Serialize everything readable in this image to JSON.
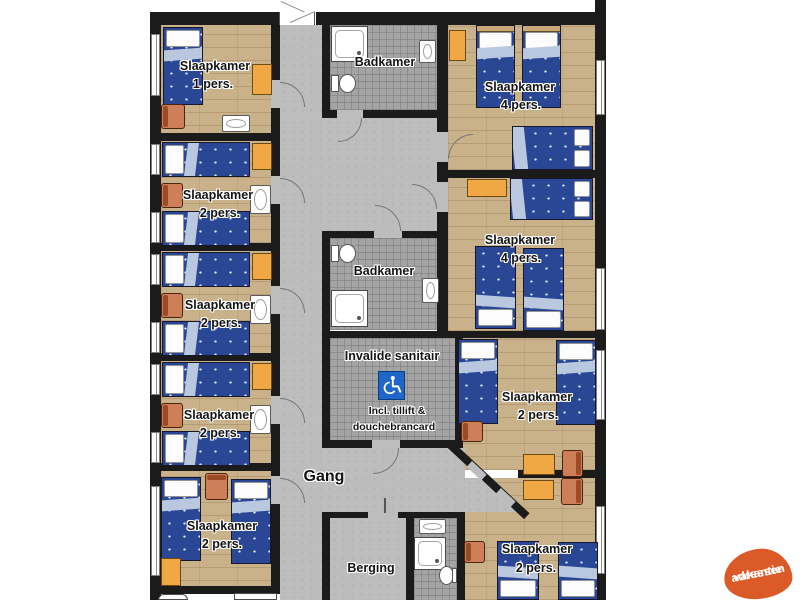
{
  "plan": {
    "rooms": {
      "left1": {
        "line1": "Slaapkamer",
        "line2": "1 pers."
      },
      "left2": {
        "line1": "Slaapkamer",
        "line2": "2 pers."
      },
      "left3": {
        "line1": "Slaapkamer",
        "line2": "2 pers."
      },
      "left4": {
        "line1": "Slaapkamer",
        "line2": "2 pers."
      },
      "left5": {
        "line1": "Slaapkamer",
        "line2": "2 pers."
      },
      "right1": {
        "line1": "Slaapkamer",
        "line2": "4 pers."
      },
      "right2": {
        "line1": "Slaapkamer",
        "line2": "4 pers."
      },
      "right3": {
        "line1": "Slaapkamer",
        "line2": "2 pers."
      },
      "right4": {
        "line1": "Slaapkamer",
        "line2": "2 pers."
      },
      "bath_top": {
        "label": "Badkamer"
      },
      "bath_mid": {
        "label": "Badkamer"
      },
      "invalide": {
        "label": "Invalide sanitair",
        "note1": "Incl. tillift &",
        "note2": "douchebrancard"
      },
      "hallway": {
        "label": "Gang"
      },
      "storage": {
        "label": "Berging"
      }
    },
    "icons": [
      "wheelchair-icon",
      "single-bed",
      "double-bed",
      "pillow",
      "shower",
      "toilet",
      "sink",
      "chair",
      "table",
      "nightstand",
      "window",
      "door-opening"
    ],
    "colors": {
      "wall": "#1b1b1b",
      "wood": "#c9b18a",
      "hall": "#bdbdbd",
      "tile": "#a4a4a4",
      "blanket": "#2a4796",
      "fold": "#b9c7df",
      "pillow": "#fcfcfc",
      "cabinet": "#efa844",
      "chair": "#cd8057",
      "chair_back": "#9c4b26",
      "sign": "#1e66c8",
      "label": "#141414",
      "logo": "#dc5a28"
    }
  },
  "logo": {
    "line1": "vakantie",
    "line2": "adressen",
    "text_color": "#FFFFFF"
  }
}
